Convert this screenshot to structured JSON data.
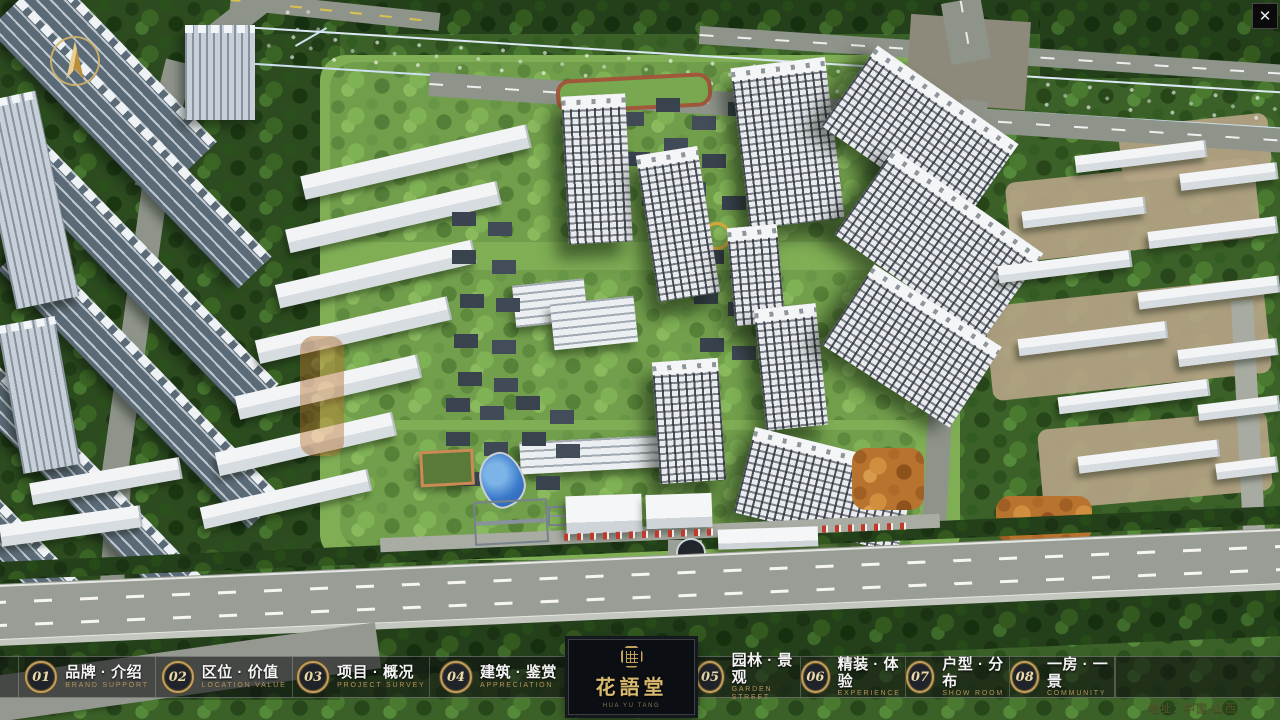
{
  "window": {
    "close_icon": "✕"
  },
  "nav": {
    "left_items": [
      {
        "num": "01",
        "title": "品牌 · 介绍",
        "subtitle": "BRAND SUPPORT"
      },
      {
        "num": "02",
        "title": "区位 · 价值",
        "subtitle": "LOCATION VALUE"
      },
      {
        "num": "03",
        "title": "项目 · 概况",
        "subtitle": "PROJECT SURVEY"
      },
      {
        "num": "04",
        "title": "建筑 · 鉴赏",
        "subtitle": "APPRECIATION"
      }
    ],
    "right_items": [
      {
        "num": "05",
        "title": "园林 · 景观",
        "subtitle": "GARDEN STREET"
      },
      {
        "num": "06",
        "title": "精装 · 体验",
        "subtitle": "EXPERIENCE"
      },
      {
        "num": "07",
        "title": "户型 · 分布",
        "subtitle": "SHOW ROOM"
      },
      {
        "num": "08",
        "title": "一房 · 一景",
        "subtitle": "COMMUNITY"
      }
    ]
  },
  "brand": {
    "name": "花語堂",
    "tagline": "HUA YU TANG"
  },
  "footer": {
    "address": "地址：中国·山西"
  },
  "icons": {
    "close": "✕",
    "compass": "north-arrow",
    "seal": "octagon-seal"
  },
  "colors": {
    "gold": "#c2a05e",
    "nav_bg": "rgba(12,14,16,0.58)",
    "river_blue": "#2f66c4",
    "flag_red": "#c0392b"
  }
}
